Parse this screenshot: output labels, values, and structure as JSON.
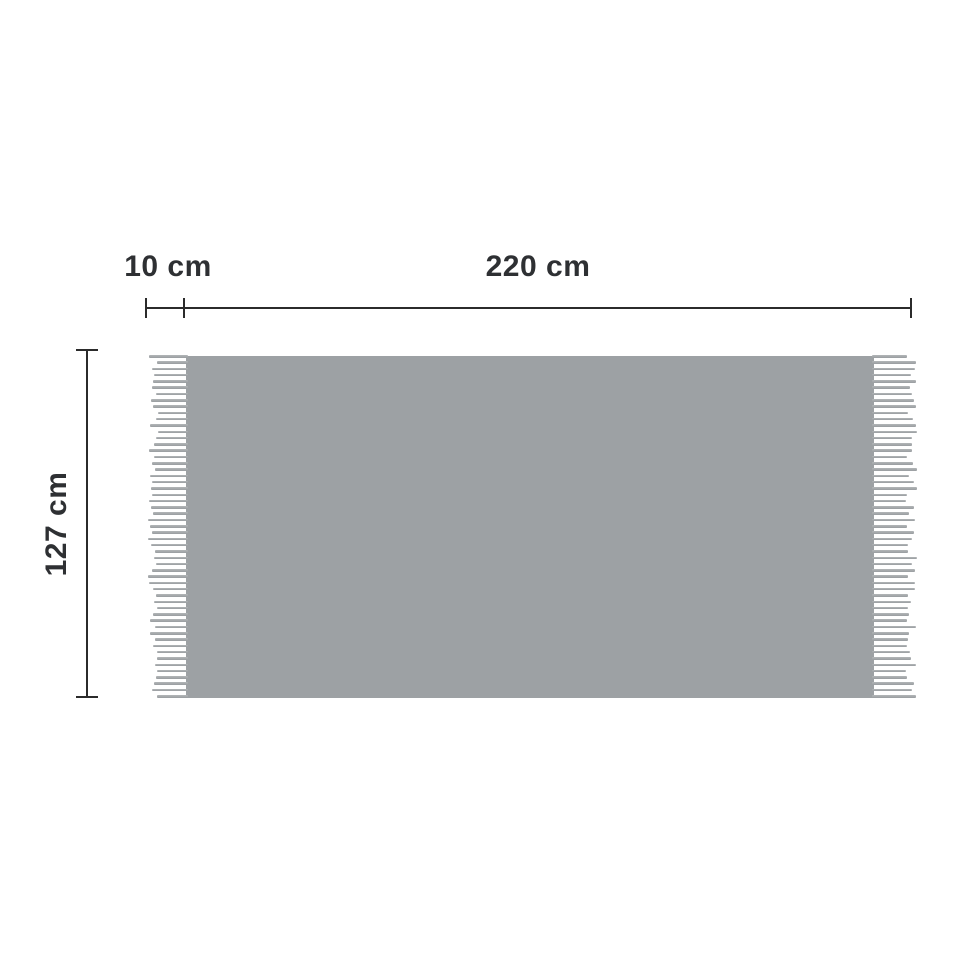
{
  "diagram": {
    "kind": "blanket-dimension-diagram",
    "labels": {
      "width": "220 cm",
      "height": "127 cm",
      "fringe": "10 cm"
    },
    "values_cm": {
      "width": 220,
      "height": 127,
      "fringe": 10
    },
    "colors": {
      "background": "#ffffff",
      "blanket_fill": "#9da1a4",
      "fringe_strand_light": "#b3b6b8",
      "fringe_strand_dark": "#999da0",
      "dimension_line": "#2b2b2b",
      "label_text": "#2e3033"
    },
    "fringe": {
      "strand_count": 55,
      "sides": [
        "left",
        "right"
      ]
    }
  }
}
